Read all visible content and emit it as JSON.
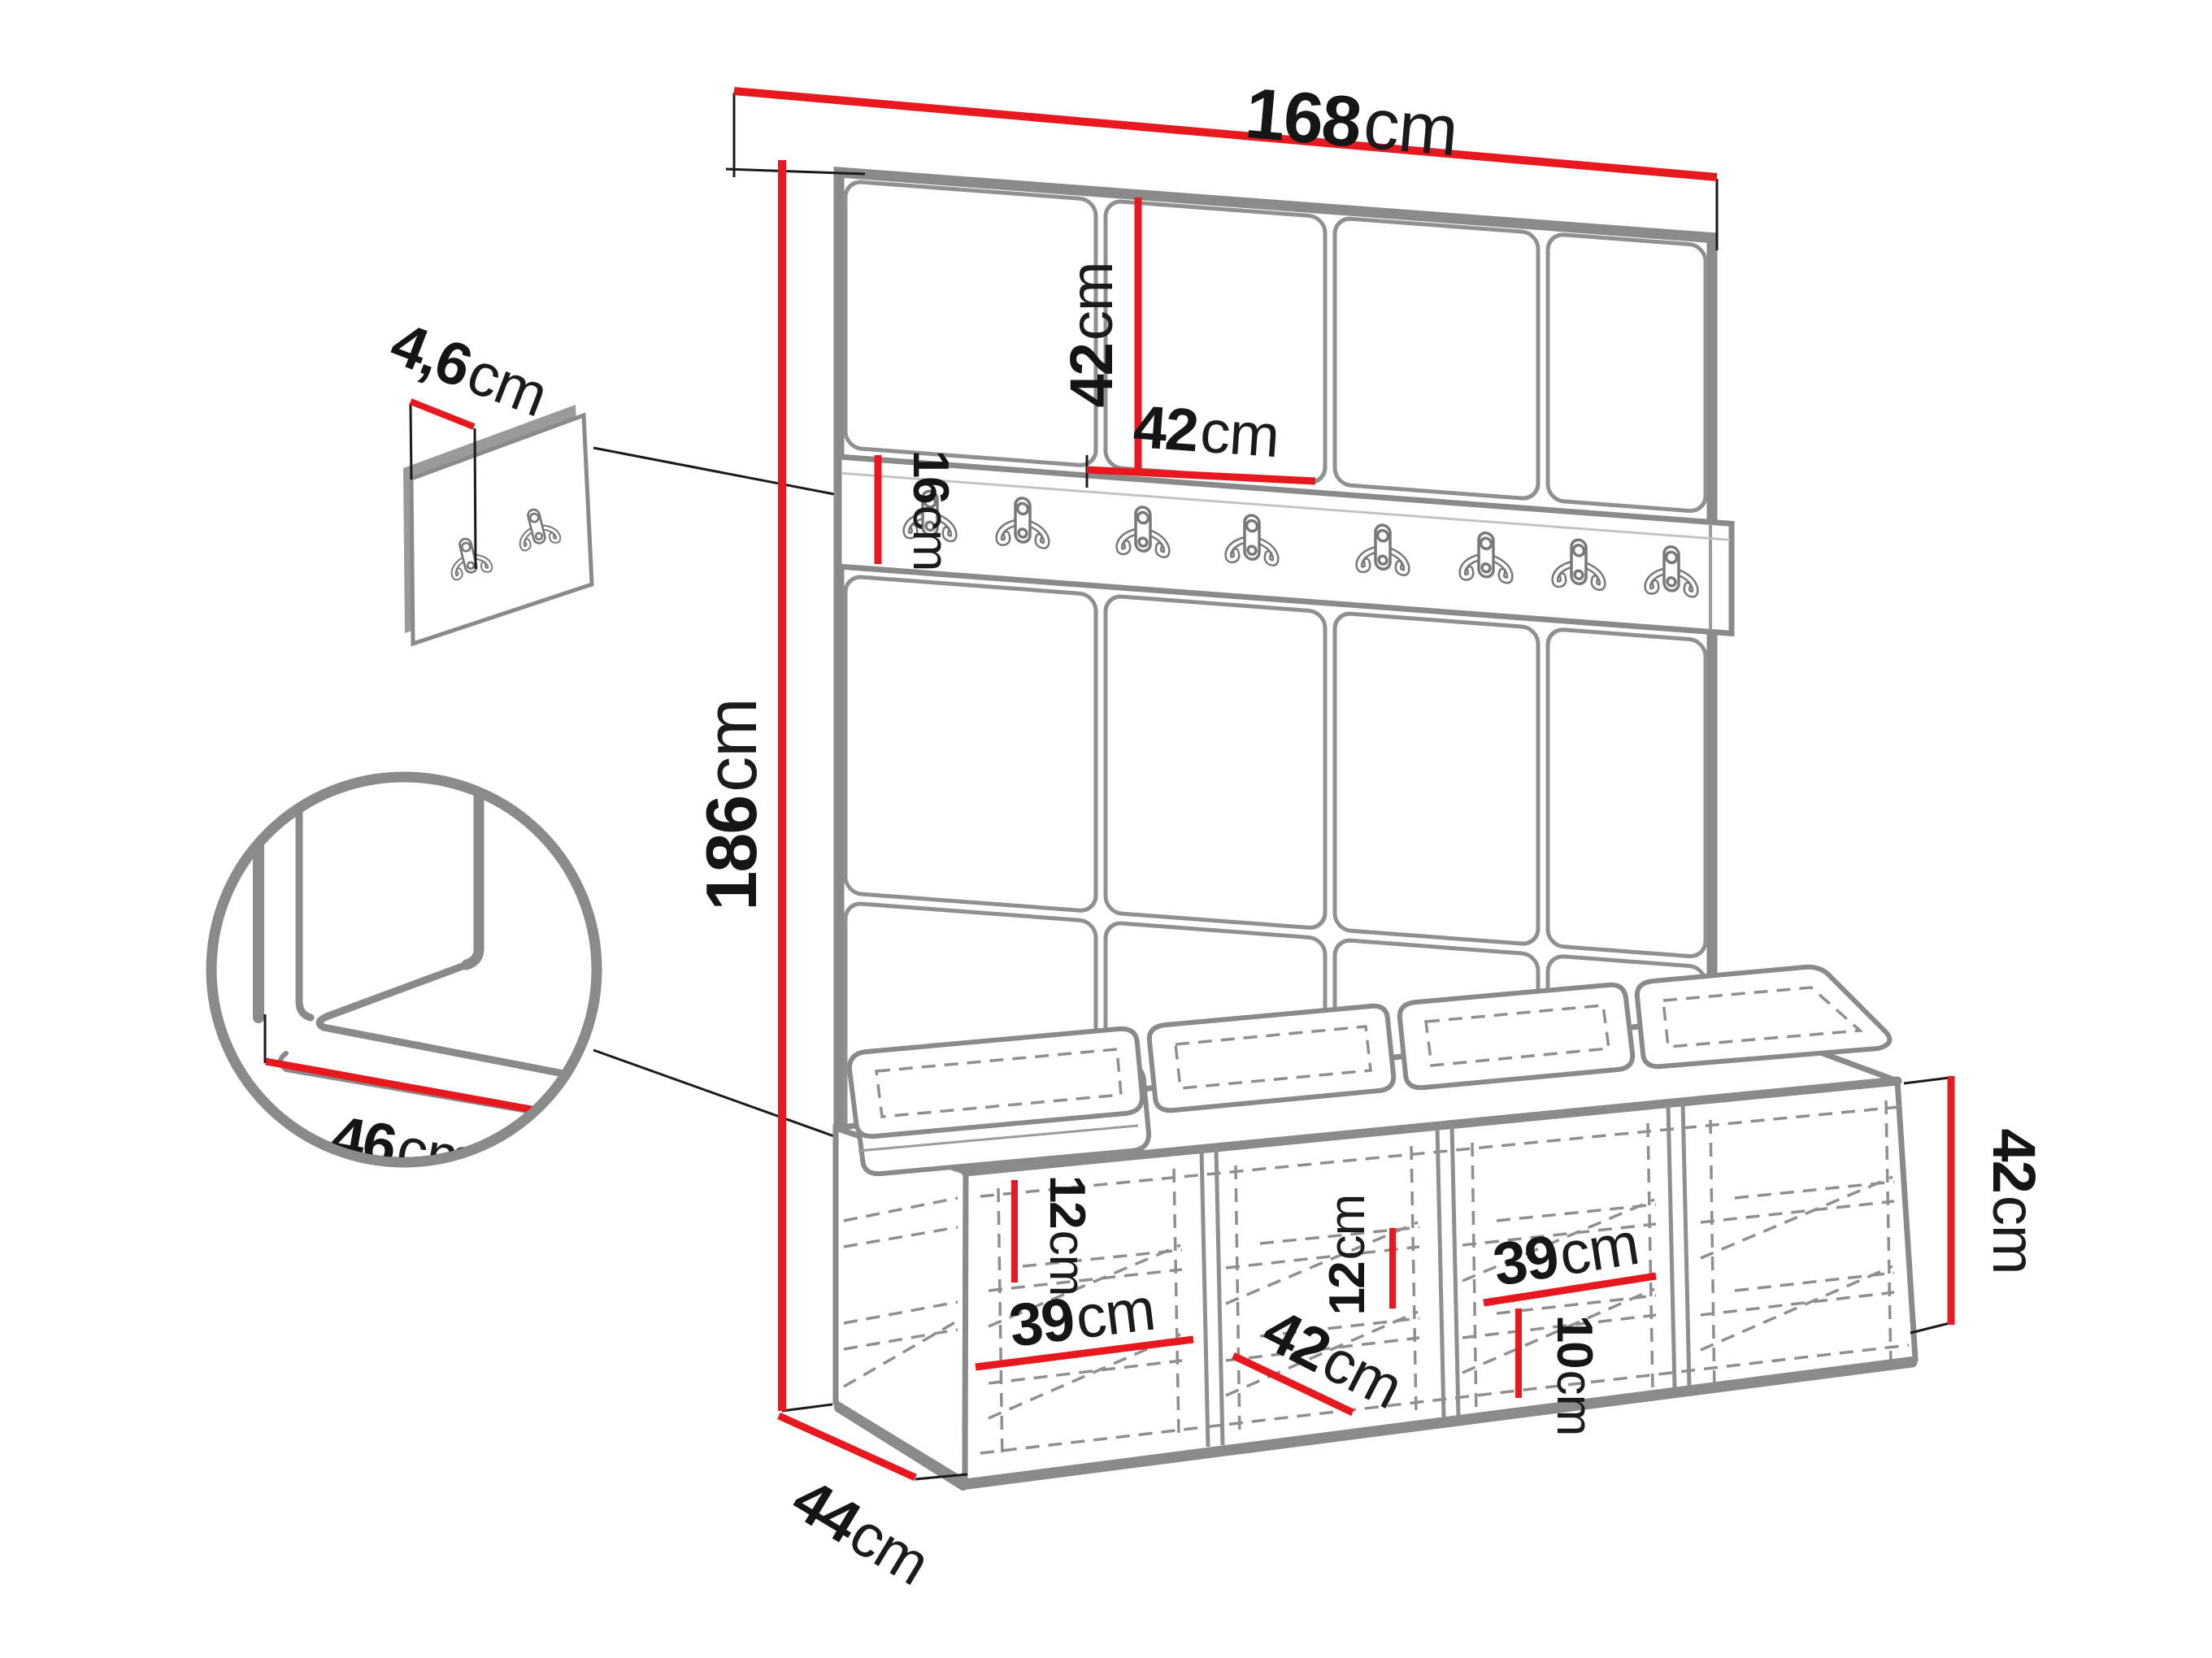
{
  "title": "Hallway furniture set dimension diagram",
  "unit": "cm",
  "colors": {
    "dimension_red": "#e8191e",
    "frame_gray": "#8a8a8a",
    "line_gray": "#9b9b9b",
    "dash_gray": "#8f8f8f",
    "text_black": "#151515",
    "background": "#ffffff"
  },
  "structure": {
    "wall_tile_columns": 4,
    "wall_tile_rows": 3,
    "rail_hooks": 8,
    "small_panel_hooks": 2,
    "seat_cushions": 4,
    "bench_compartments": 4
  },
  "dims": {
    "total_width": {
      "value": "168",
      "unit": "cm"
    },
    "total_height": {
      "value": "186",
      "unit": "cm"
    },
    "tile_height": {
      "value": "42",
      "unit": "cm"
    },
    "tile_width": {
      "value": "42",
      "unit": "cm"
    },
    "rail_height": {
      "value": "16",
      "unit": "cm"
    },
    "panel_thickness": {
      "value": "4,6",
      "unit": "cm"
    },
    "seat_depth": {
      "value": "46",
      "unit": "cm"
    },
    "bench_depth": {
      "value": "44",
      "unit": "cm"
    },
    "bench_height": {
      "value": "42",
      "unit": "cm"
    },
    "left_shelf_spacing": {
      "value": "12",
      "unit": "cm"
    },
    "left_compartment_width": {
      "value": "39",
      "unit": "cm"
    },
    "bench_inner_depth": {
      "value": "42",
      "unit": "cm"
    },
    "middle_shelf_spacing": {
      "value": "12",
      "unit": "cm"
    },
    "right_compartment_width": {
      "value": "39",
      "unit": "cm"
    },
    "bottom_shelf_spacing": {
      "value": "10",
      "unit": "cm"
    }
  }
}
